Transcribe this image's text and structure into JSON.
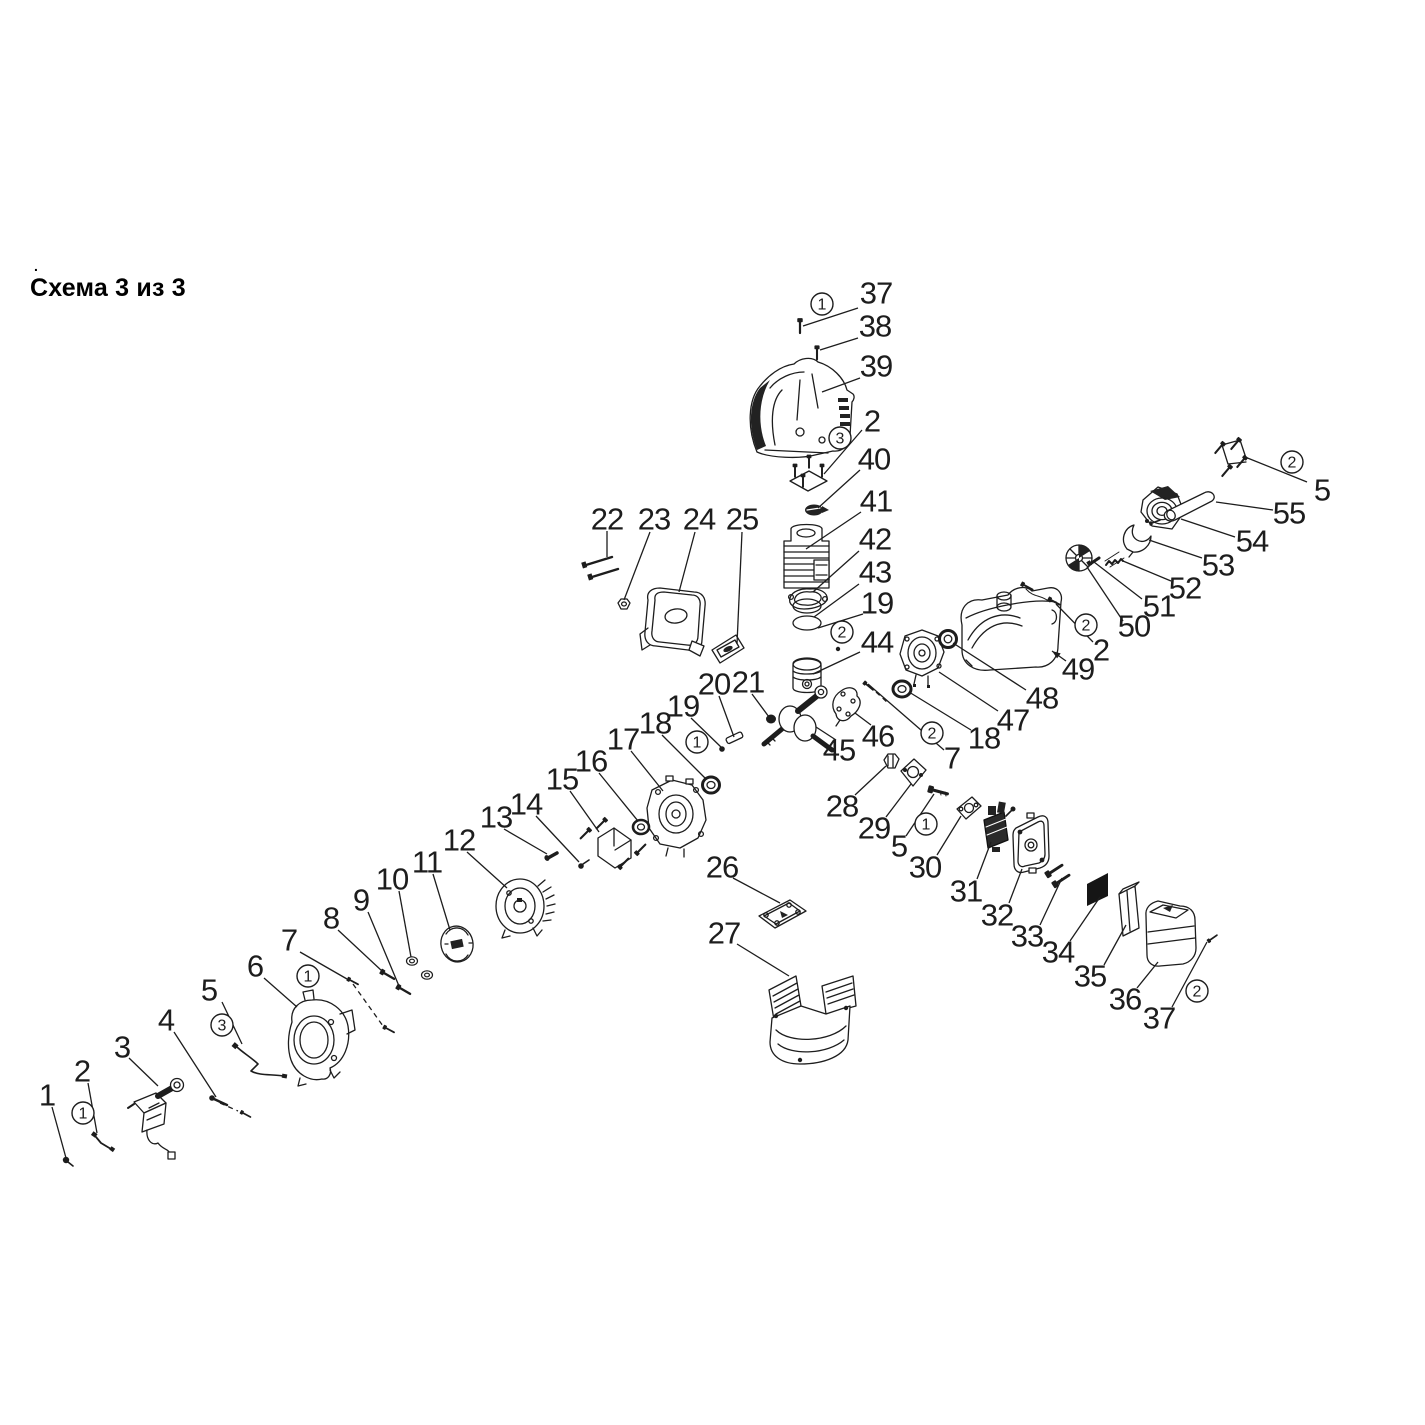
{
  "title": {
    "text": "Схема 3 из 3",
    "dot": "."
  },
  "diagram": {
    "canvas": {
      "width": 1425,
      "height": 1425,
      "background": "#ffffff",
      "ink": "#1d1d1d"
    },
    "labels": [
      {
        "t": "37",
        "x": 876,
        "y": 293
      },
      {
        "t": "38",
        "x": 875,
        "y": 326
      },
      {
        "t": "39",
        "x": 876,
        "y": 366
      },
      {
        "t": "2",
        "x": 872,
        "y": 421
      },
      {
        "t": "40",
        "x": 874,
        "y": 459
      },
      {
        "t": "41",
        "x": 876,
        "y": 501
      },
      {
        "t": "42",
        "x": 875,
        "y": 539
      },
      {
        "t": "43",
        "x": 875,
        "y": 572
      },
      {
        "t": "19",
        "x": 877,
        "y": 603
      },
      {
        "t": "44",
        "x": 877,
        "y": 642
      },
      {
        "t": "22",
        "x": 607,
        "y": 519
      },
      {
        "t": "23",
        "x": 654,
        "y": 519
      },
      {
        "t": "24",
        "x": 699,
        "y": 519
      },
      {
        "t": "25",
        "x": 742,
        "y": 519
      },
      {
        "t": "20",
        "x": 714,
        "y": 684
      },
      {
        "t": "21",
        "x": 748,
        "y": 682
      },
      {
        "t": "19",
        "x": 683,
        "y": 706
      },
      {
        "t": "18",
        "x": 655,
        "y": 723
      },
      {
        "t": "17",
        "x": 623,
        "y": 739
      },
      {
        "t": "16",
        "x": 591,
        "y": 761
      },
      {
        "t": "15",
        "x": 562,
        "y": 779
      },
      {
        "t": "14",
        "x": 526,
        "y": 804
      },
      {
        "t": "13",
        "x": 496,
        "y": 817
      },
      {
        "t": "12",
        "x": 459,
        "y": 840
      },
      {
        "t": "11",
        "x": 427,
        "y": 862
      },
      {
        "t": "10",
        "x": 392,
        "y": 879
      },
      {
        "t": "9",
        "x": 361,
        "y": 900
      },
      {
        "t": "8",
        "x": 331,
        "y": 918
      },
      {
        "t": "7",
        "x": 289,
        "y": 940
      },
      {
        "t": "6",
        "x": 255,
        "y": 966
      },
      {
        "t": "5",
        "x": 209,
        "y": 990
      },
      {
        "t": "4",
        "x": 166,
        "y": 1020
      },
      {
        "t": "3",
        "x": 122,
        "y": 1047
      },
      {
        "t": "2",
        "x": 82,
        "y": 1071
      },
      {
        "t": "1",
        "x": 47,
        "y": 1095
      },
      {
        "t": "26",
        "x": 722,
        "y": 867
      },
      {
        "t": "27",
        "x": 724,
        "y": 933
      },
      {
        "t": "45",
        "x": 839,
        "y": 750
      },
      {
        "t": "46",
        "x": 878,
        "y": 736
      },
      {
        "t": "28",
        "x": 842,
        "y": 806
      },
      {
        "t": "29",
        "x": 874,
        "y": 828
      },
      {
        "t": "5",
        "x": 899,
        "y": 846
      },
      {
        "t": "30",
        "x": 925,
        "y": 867
      },
      {
        "t": "31",
        "x": 966,
        "y": 891
      },
      {
        "t": "32",
        "x": 997,
        "y": 915
      },
      {
        "t": "33",
        "x": 1027,
        "y": 936
      },
      {
        "t": "34",
        "x": 1058,
        "y": 952
      },
      {
        "t": "35",
        "x": 1090,
        "y": 976
      },
      {
        "t": "36",
        "x": 1125,
        "y": 999
      },
      {
        "t": "37",
        "x": 1159,
        "y": 1018
      },
      {
        "t": "7",
        "x": 952,
        "y": 758
      },
      {
        "t": "18",
        "x": 984,
        "y": 738
      },
      {
        "t": "47",
        "x": 1013,
        "y": 720
      },
      {
        "t": "48",
        "x": 1042,
        "y": 698
      },
      {
        "t": "49",
        "x": 1078,
        "y": 669
      },
      {
        "t": "2",
        "x": 1101,
        "y": 650
      },
      {
        "t": "50",
        "x": 1134,
        "y": 626
      },
      {
        "t": "51",
        "x": 1159,
        "y": 606
      },
      {
        "t": "52",
        "x": 1185,
        "y": 588
      },
      {
        "t": "53",
        "x": 1218,
        "y": 565
      },
      {
        "t": "54",
        "x": 1252,
        "y": 541
      },
      {
        "t": "55",
        "x": 1289,
        "y": 513
      },
      {
        "t": "5",
        "x": 1322,
        "y": 490
      }
    ],
    "markers": [
      {
        "n": "1",
        "x": 822,
        "y": 304
      },
      {
        "n": "3",
        "x": 840,
        "y": 438
      },
      {
        "n": "2",
        "x": 842,
        "y": 632
      },
      {
        "n": "1",
        "x": 697,
        "y": 742
      },
      {
        "n": "1",
        "x": 308,
        "y": 976
      },
      {
        "n": "3",
        "x": 222,
        "y": 1025
      },
      {
        "n": "1",
        "x": 83,
        "y": 1113
      },
      {
        "n": "1",
        "x": 926,
        "y": 824
      },
      {
        "n": "2",
        "x": 932,
        "y": 733
      },
      {
        "n": "2",
        "x": 1197,
        "y": 991
      },
      {
        "n": "2",
        "x": 1086,
        "y": 625
      },
      {
        "n": "2",
        "x": 1292,
        "y": 462
      }
    ],
    "leaders": [
      {
        "x1": 858,
        "y1": 308,
        "x2": 803,
        "y2": 326
      },
      {
        "x1": 858,
        "y1": 338,
        "x2": 820,
        "y2": 350
      },
      {
        "x1": 860,
        "y1": 378,
        "x2": 822,
        "y2": 392
      },
      {
        "x1": 862,
        "y1": 430,
        "x2": 824,
        "y2": 474
      },
      {
        "x1": 860,
        "y1": 470,
        "x2": 818,
        "y2": 508
      },
      {
        "x1": 861,
        "y1": 512,
        "x2": 806,
        "y2": 549
      },
      {
        "x1": 859,
        "y1": 551,
        "x2": 813,
        "y2": 592
      },
      {
        "x1": 859,
        "y1": 584,
        "x2": 814,
        "y2": 617
      },
      {
        "x1": 863,
        "y1": 614,
        "x2": 818,
        "y2": 628
      },
      {
        "x1": 860,
        "y1": 652,
        "x2": 813,
        "y2": 674
      },
      {
        "x1": 607,
        "y1": 531,
        "x2": 607,
        "y2": 557
      },
      {
        "x1": 650,
        "y1": 532,
        "x2": 624,
        "y2": 600
      },
      {
        "x1": 695,
        "y1": 532,
        "x2": 679,
        "y2": 592
      },
      {
        "x1": 742,
        "y1": 532,
        "x2": 737,
        "y2": 644
      },
      {
        "x1": 719,
        "y1": 696,
        "x2": 734,
        "y2": 737
      },
      {
        "x1": 752,
        "y1": 694,
        "x2": 769,
        "y2": 717
      },
      {
        "x1": 691,
        "y1": 718,
        "x2": 722,
        "y2": 748
      },
      {
        "x1": 662,
        "y1": 735,
        "x2": 706,
        "y2": 779
      },
      {
        "x1": 631,
        "y1": 751,
        "x2": 663,
        "y2": 791
      },
      {
        "x1": 599,
        "y1": 773,
        "x2": 638,
        "y2": 821
      },
      {
        "x1": 570,
        "y1": 791,
        "x2": 599,
        "y2": 832
      },
      {
        "x1": 536,
        "y1": 816,
        "x2": 579,
        "y2": 862
      },
      {
        "x1": 504,
        "y1": 829,
        "x2": 547,
        "y2": 854
      },
      {
        "x1": 467,
        "y1": 852,
        "x2": 507,
        "y2": 888
      },
      {
        "x1": 433,
        "y1": 874,
        "x2": 450,
        "y2": 930
      },
      {
        "x1": 399,
        "y1": 891,
        "x2": 411,
        "y2": 957
      },
      {
        "x1": 368,
        "y1": 912,
        "x2": 399,
        "y2": 986
      },
      {
        "x1": 338,
        "y1": 930,
        "x2": 382,
        "y2": 971
      },
      {
        "x1": 300,
        "y1": 952,
        "x2": 347,
        "y2": 979
      },
      {
        "x1": 353,
        "y1": 984,
        "x2": 383,
        "y2": 1026,
        "dash": true
      },
      {
        "x1": 264,
        "y1": 978,
        "x2": 297,
        "y2": 1007
      },
      {
        "x1": 222,
        "y1": 1002,
        "x2": 242,
        "y2": 1044
      },
      {
        "x1": 174,
        "y1": 1032,
        "x2": 216,
        "y2": 1097
      },
      {
        "x1": 220,
        "y1": 1103,
        "x2": 238,
        "y2": 1111,
        "dash": true
      },
      {
        "x1": 129,
        "y1": 1058,
        "x2": 158,
        "y2": 1086
      },
      {
        "x1": 88,
        "y1": 1083,
        "x2": 97,
        "y2": 1133
      },
      {
        "x1": 52,
        "y1": 1107,
        "x2": 66,
        "y2": 1158
      },
      {
        "x1": 733,
        "y1": 878,
        "x2": 780,
        "y2": 903
      },
      {
        "x1": 737,
        "y1": 944,
        "x2": 789,
        "y2": 976
      },
      {
        "x1": 836,
        "y1": 740,
        "x2": 816,
        "y2": 727
      },
      {
        "x1": 871,
        "y1": 725,
        "x2": 855,
        "y2": 713
      },
      {
        "x1": 855,
        "y1": 795,
        "x2": 886,
        "y2": 766
      },
      {
        "x1": 886,
        "y1": 817,
        "x2": 911,
        "y2": 784
      },
      {
        "x1": 906,
        "y1": 836,
        "x2": 934,
        "y2": 794
      },
      {
        "x1": 937,
        "y1": 855,
        "x2": 961,
        "y2": 816
      },
      {
        "x1": 977,
        "y1": 879,
        "x2": 991,
        "y2": 842
      },
      {
        "x1": 1009,
        "y1": 903,
        "x2": 1022,
        "y2": 869
      },
      {
        "x1": 1040,
        "y1": 925,
        "x2": 1062,
        "y2": 878
      },
      {
        "x1": 1070,
        "y1": 941,
        "x2": 1100,
        "y2": 897
      },
      {
        "x1": 1104,
        "y1": 965,
        "x2": 1126,
        "y2": 925
      },
      {
        "x1": 1137,
        "y1": 988,
        "x2": 1158,
        "y2": 962
      },
      {
        "x1": 1172,
        "y1": 1007,
        "x2": 1207,
        "y2": 942
      },
      {
        "x1": 944,
        "y1": 750,
        "x2": 868,
        "y2": 684
      },
      {
        "x1": 876,
        "y1": 692,
        "x2": 888,
        "y2": 703,
        "dash": true
      },
      {
        "x1": 971,
        "y1": 730,
        "x2": 909,
        "y2": 692
      },
      {
        "x1": 998,
        "y1": 711,
        "x2": 939,
        "y2": 672
      },
      {
        "x1": 1026,
        "y1": 690,
        "x2": 953,
        "y2": 643
      },
      {
        "x1": 1066,
        "y1": 661,
        "x2": 1052,
        "y2": 651,
        "arrow": true
      },
      {
        "x1": 1093,
        "y1": 642,
        "x2": 1056,
        "y2": 604
      },
      {
        "x1": 1123,
        "y1": 621,
        "x2": 1087,
        "y2": 567
      },
      {
        "x1": 1142,
        "y1": 599,
        "x2": 1094,
        "y2": 562
      },
      {
        "x1": 1171,
        "y1": 581,
        "x2": 1123,
        "y2": 561
      },
      {
        "x1": 1202,
        "y1": 558,
        "x2": 1149,
        "y2": 540
      },
      {
        "x1": 1235,
        "y1": 537,
        "x2": 1181,
        "y2": 519
      },
      {
        "x1": 1273,
        "y1": 510,
        "x2": 1216,
        "y2": 502
      },
      {
        "x1": 1307,
        "y1": 482,
        "x2": 1245,
        "y2": 457
      }
    ]
  }
}
